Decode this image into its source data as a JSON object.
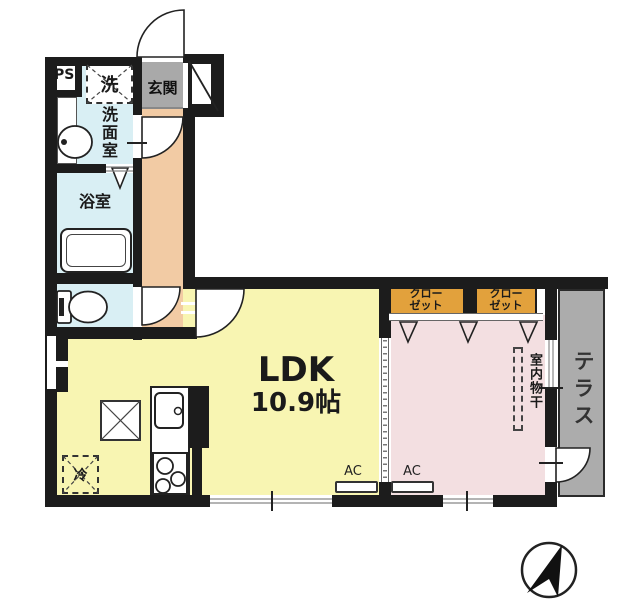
{
  "floorplan": {
    "rooms": {
      "entrance": {
        "label": "玄関"
      },
      "pipe_space": {
        "label": "PS"
      },
      "washing_machine": {
        "label": "洗"
      },
      "washroom": {
        "label": "洗面室"
      },
      "bathroom": {
        "label": "浴室"
      },
      "ldk": {
        "label": "LDK",
        "size": "10.9帖"
      },
      "closet_left": {
        "line1": "クロー",
        "line2": "ゼット"
      },
      "closet_right": {
        "line1": "クロー",
        "line2": "ゼット"
      },
      "indoor_drying": {
        "label": "室内物干"
      },
      "terrace": {
        "label": "テラス"
      },
      "refrigerator": {
        "label": "冷"
      },
      "ac_ldk": {
        "label": "AC"
      },
      "ac_bedroom": {
        "label": "AC"
      }
    },
    "colors": {
      "wall": "#1c1c1c",
      "ldk": "#F8F5B2",
      "bedroom": "#F3DFE1",
      "hallway": "#F2CBA4",
      "entrance": "#A9A9A9",
      "wet_rooms": "#D9EFF4",
      "closet": "#E2A13C",
      "terrace": "#ACACAC"
    }
  }
}
